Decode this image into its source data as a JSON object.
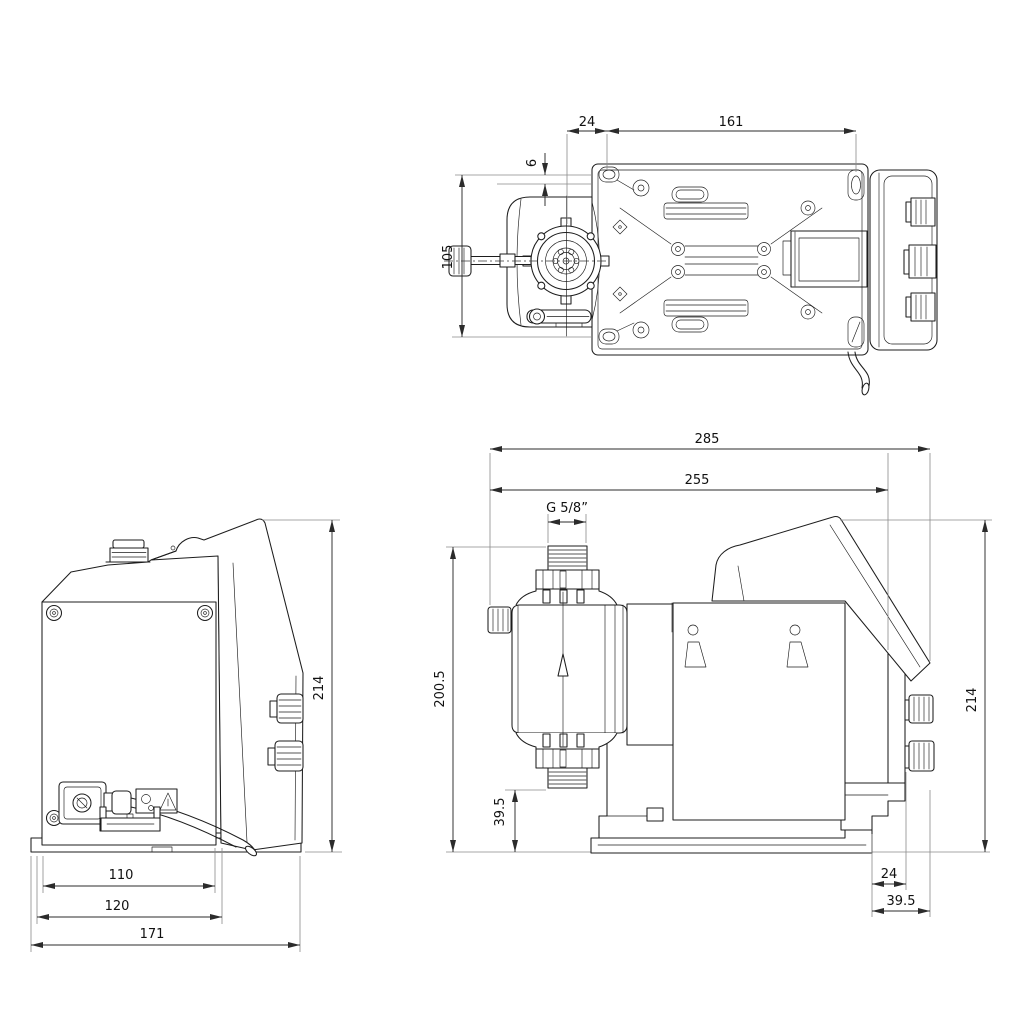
{
  "page": {
    "background": "#ffffff"
  },
  "drawing": {
    "type": "technical-dimension-drawing",
    "subject": "Diaphragm dosing pump - three orthographic views with dimensions (mm)",
    "colors": {
      "line": "#1d1d1d",
      "dimension": "#2b2b2b",
      "extension": "#8a8a8a",
      "text": "#111111",
      "background": "#ffffff"
    },
    "icons": {
      "flow_direction_arrow": "hollow up-arrow on dosing head",
      "warning_triangle": "triangle symbol on label"
    },
    "views": {
      "top": {
        "name": "top view",
        "dims": {
          "head_to_hole": "24",
          "hole_spacing_length": "161",
          "edge_to_hole": "6",
          "hole_spacing_width": "105"
        }
      },
      "front": {
        "name": "front view",
        "dims": {
          "overall_height": "214",
          "foot_width_inner": "110",
          "foot_width": "120",
          "base_width": "171"
        }
      },
      "side": {
        "name": "side view",
        "dims": {
          "overall_length": "285",
          "length_to_back": "255",
          "connection_thread": "G 5/8”",
          "height_to_connection": "200.5",
          "suction_valve_height": "39.5",
          "overall_height": "214",
          "back_offset": "24",
          "back_depth": "39.5"
        }
      }
    }
  }
}
